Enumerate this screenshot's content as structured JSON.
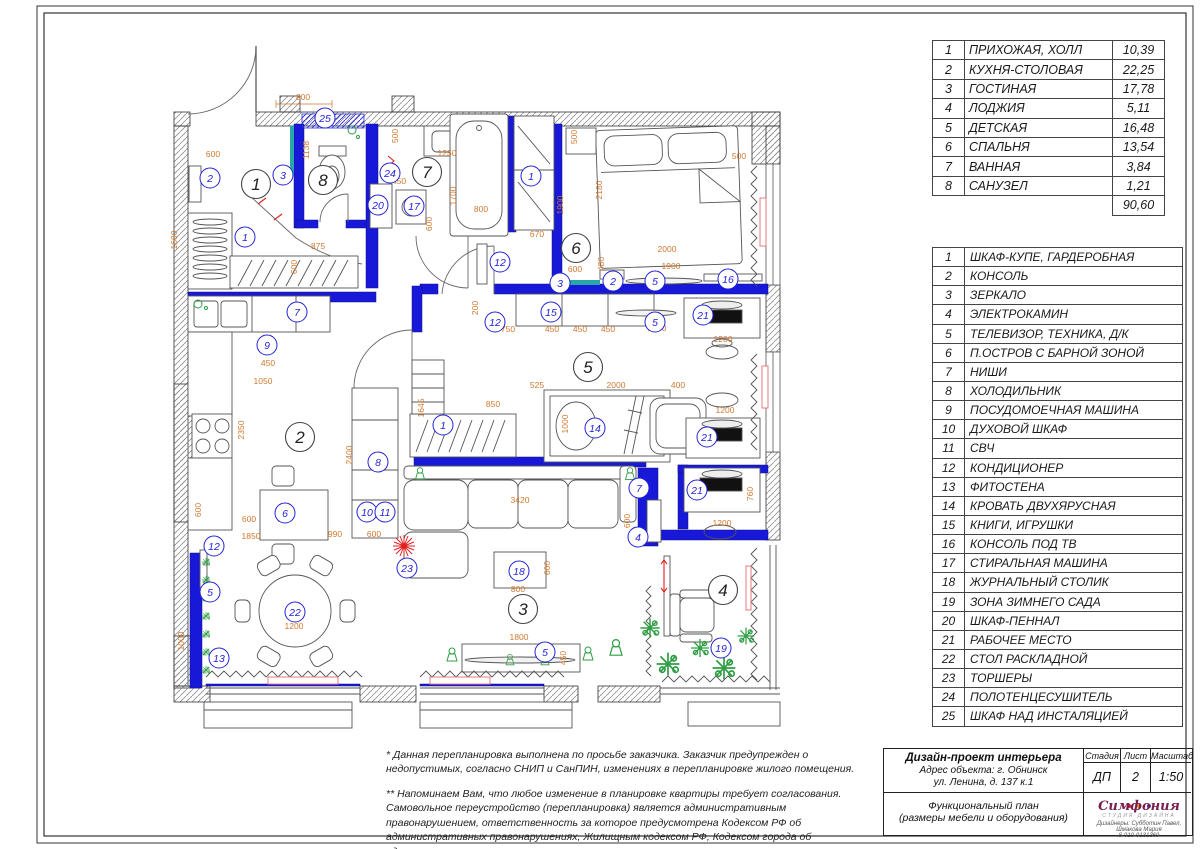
{
  "rooms_table": {
    "rows": [
      {
        "n": "1",
        "name": "ПРИХОЖАЯ, ХОЛЛ",
        "area": "10,39"
      },
      {
        "n": "2",
        "name": "КУХНЯ-СТОЛОВАЯ",
        "area": "22,25"
      },
      {
        "n": "3",
        "name": "ГОСТИНАЯ",
        "area": "17,78"
      },
      {
        "n": "4",
        "name": "ЛОДЖИЯ",
        "area": "5,11"
      },
      {
        "n": "5",
        "name": "ДЕТСКАЯ",
        "area": "16,48"
      },
      {
        "n": "6",
        "name": "СПАЛЬНЯ",
        "area": "13,54"
      },
      {
        "n": "7",
        "name": "ВАННАЯ",
        "area": "3,84"
      },
      {
        "n": "8",
        "name": "САНУЗЕЛ",
        "area": "1,21"
      }
    ],
    "total": "90,60"
  },
  "legend_table": {
    "rows": [
      {
        "n": "1",
        "name": "ШКАФ-КУПЕ, ГАРДЕРОБНАЯ"
      },
      {
        "n": "2",
        "name": "КОНСОЛЬ"
      },
      {
        "n": "3",
        "name": "ЗЕРКАЛО"
      },
      {
        "n": "4",
        "name": "ЭЛЕКТРОКАМИН"
      },
      {
        "n": "5",
        "name": "ТЕЛЕВИЗОР, ТЕХНИКА, Д/К"
      },
      {
        "n": "6",
        "name": "П.ОСТРОВ С БАРНОЙ ЗОНОЙ"
      },
      {
        "n": "7",
        "name": "НИШИ"
      },
      {
        "n": "8",
        "name": "ХОЛОДИЛЬНИК"
      },
      {
        "n": "9",
        "name": "ПОСУДОМОЕЧНАЯ МАШИНА"
      },
      {
        "n": "10",
        "name": "ДУХОВОЙ ШКАФ"
      },
      {
        "n": "11",
        "name": "СВЧ"
      },
      {
        "n": "12",
        "name": "КОНДИЦИОНЕР"
      },
      {
        "n": "13",
        "name": "ФИТОСТЕНА"
      },
      {
        "n": "14",
        "name": "КРОВАТЬ ДВУХЯРУСНАЯ"
      },
      {
        "n": "15",
        "name": "КНИГИ, ИГРУШКИ"
      },
      {
        "n": "16",
        "name": "КОНСОЛЬ ПОД ТВ"
      },
      {
        "n": "17",
        "name": "СТИРАЛЬНАЯ МАШИНА"
      },
      {
        "n": "18",
        "name": "ЖУРНАЛЬНЫЙ СТОЛИК"
      },
      {
        "n": "19",
        "name": "ЗОНА ЗИМНЕГО САДА"
      },
      {
        "n": "20",
        "name": "ШКАФ-ПЕННАЛ"
      },
      {
        "n": "21",
        "name": "РАБОЧЕЕ МЕСТО"
      },
      {
        "n": "22",
        "name": "СТОЛ РАСКЛАДНОЙ"
      },
      {
        "n": "23",
        "name": "ТОРШЕРЫ"
      },
      {
        "n": "24",
        "name": "ПОЛОТЕНЦЕСУШИТЕЛЬ"
      },
      {
        "n": "25",
        "name": "ШКАФ НАД ИНСТАЛЯЦИЕЙ"
      }
    ]
  },
  "notes": {
    "p1": "* Данная перепланировка выполнена по просьбе заказчика. Заказчик предупрежден о недопустимых, согласно СНИП и СанПИН, изменениях в перепланировке жилого помещения.",
    "p2": "** Напоминаем Вам, что любое изменение в планировке квартиры требует согласования. Самовольное переустройство (перепланировка) является административным правонарушением, ответственность за которое предусмотрена Кодексом РФ об административных правонарушениях, Жилищным кодексом РФ, Кодексом города об административных правонарушениях."
  },
  "title_block": {
    "project": "Дизайн-проект интерьера",
    "address1": "Адрес объекта: г. Обнинск",
    "address2": "ул. Ленина, д. 137 к.1",
    "stage_label": "Стадия",
    "sheet_label": "Лист",
    "scale_label": "Масштаб",
    "stage": "ДП",
    "sheet": "2",
    "scale": "1:50",
    "doc1": "Функциональный план",
    "doc2": "(размеры мебели и оборудования)",
    "studio": "Симфония",
    "studio_sub": "СТУДИЯ ДИЗАЙНА",
    "designers": "Дизайнеры: Субботин Павел, Шмакова Мария",
    "phone": "8-910-9131369",
    "logo_dot_colors": [
      "#cc2222",
      "#e8a000",
      "#2244cc"
    ]
  },
  "plan": {
    "accent_colors": {
      "walls_blue": "#1818d8",
      "dims_orange": "#d07830",
      "items_blue": "#2323d6",
      "mirror_teal": "#27a7a7",
      "plants_green": "#2f9e44",
      "radiator_pink": "#e87a7a",
      "lamp_red": "#e02020"
    },
    "room_labels": [
      [
        "1",
        256,
        184
      ],
      [
        "8",
        323,
        180
      ],
      [
        "7",
        427,
        172
      ],
      [
        "6",
        576,
        248
      ],
      [
        "2",
        300,
        437
      ],
      [
        "5",
        588,
        367
      ],
      [
        "3",
        523,
        609
      ],
      [
        "4",
        723,
        590
      ]
    ],
    "item_labels": [
      [
        "25",
        325,
        118
      ],
      [
        "3",
        283,
        175
      ],
      [
        "2",
        210,
        178
      ],
      [
        "1",
        245,
        237
      ],
      [
        "24",
        390,
        173
      ],
      [
        "20",
        378,
        205
      ],
      [
        "17",
        414,
        206
      ],
      [
        "1",
        531,
        176
      ],
      [
        "12",
        500,
        262
      ],
      [
        "3",
        560,
        283
      ],
      [
        "2",
        613,
        281
      ],
      [
        "5",
        655,
        281
      ],
      [
        "16",
        728,
        279
      ],
      [
        "7",
        297,
        312
      ],
      [
        "15",
        551,
        312
      ],
      [
        "5",
        655,
        322
      ],
      [
        "12",
        495,
        322
      ],
      [
        "21",
        703,
        315
      ],
      [
        "9",
        267,
        345
      ],
      [
        "8",
        378,
        462
      ],
      [
        "1",
        443,
        425
      ],
      [
        "14",
        595,
        428
      ],
      [
        "21",
        707,
        437
      ],
      [
        "10",
        367,
        512
      ],
      [
        "11",
        385,
        512
      ],
      [
        "6",
        285,
        513
      ],
      [
        "12",
        214,
        546
      ],
      [
        "5",
        210,
        592
      ],
      [
        "21",
        697,
        490
      ],
      [
        "7",
        639,
        488
      ],
      [
        "4",
        638,
        537
      ],
      [
        "18",
        519,
        571
      ],
      [
        "23",
        407,
        568
      ],
      [
        "22",
        295,
        612
      ],
      [
        "13",
        219,
        658
      ],
      [
        "19",
        721,
        648
      ],
      [
        "5",
        545,
        652
      ]
    ],
    "dimensions": [
      [
        "800",
        303,
        100,
        0
      ],
      [
        "600",
        213,
        157,
        0
      ],
      [
        "1138",
        309,
        150,
        1
      ],
      [
        "500",
        398,
        136,
        1
      ],
      [
        "1250",
        447,
        156,
        0
      ],
      [
        "450",
        399,
        184,
        0
      ],
      [
        "1700",
        456,
        196,
        1
      ],
      [
        "800",
        481,
        212,
        0
      ],
      [
        "600",
        432,
        224,
        1
      ],
      [
        "500",
        577,
        137,
        1
      ],
      [
        "1900",
        563,
        205,
        1
      ],
      [
        "670",
        537,
        237,
        0
      ],
      [
        "500",
        739,
        159,
        0
      ],
      [
        "2180",
        602,
        190,
        1
      ],
      [
        "2000",
        667,
        252,
        0
      ],
      [
        "1900",
        671,
        269,
        0
      ],
      [
        "480",
        604,
        264,
        1
      ],
      [
        "600",
        575,
        272,
        0
      ],
      [
        "875",
        318,
        249,
        0
      ],
      [
        "600",
        297,
        267,
        1
      ],
      [
        "1600",
        177,
        240,
        1
      ],
      [
        "200",
        478,
        308,
        1
      ],
      [
        "750",
        508,
        332,
        0
      ],
      [
        "450",
        552,
        332,
        0
      ],
      [
        "450",
        580,
        332,
        0
      ],
      [
        "450",
        608,
        332,
        0
      ],
      [
        "385",
        559,
        311,
        1
      ],
      [
        "1200",
        657,
        331,
        0
      ],
      [
        "450",
        268,
        366,
        0
      ],
      [
        "1050",
        263,
        384,
        0
      ],
      [
        "2350",
        244,
        430,
        1
      ],
      [
        "600",
        201,
        510,
        1
      ],
      [
        "600",
        249,
        522,
        0
      ],
      [
        "600",
        284,
        522,
        0
      ],
      [
        "1850",
        251,
        539,
        0
      ],
      [
        "990",
        335,
        537,
        0
      ],
      [
        "600",
        374,
        537,
        0
      ],
      [
        "2400",
        352,
        455,
        1
      ],
      [
        "1645",
        424,
        408,
        1
      ],
      [
        "850",
        493,
        407,
        0
      ],
      [
        "525",
        537,
        388,
        0
      ],
      [
        "2000",
        616,
        388,
        0
      ],
      [
        "1000",
        568,
        424,
        1
      ],
      [
        "3420",
        520,
        503,
        0
      ],
      [
        "400",
        678,
        388,
        0
      ],
      [
        "1200",
        723,
        342,
        0
      ],
      [
        "1200",
        725,
        413,
        0
      ],
      [
        "1200",
        722,
        526,
        0
      ],
      [
        "760",
        753,
        494,
        1
      ],
      [
        "1200",
        294,
        629,
        0
      ],
      [
        "1000",
        184,
        641,
        1
      ],
      [
        "800",
        518,
        592,
        0
      ],
      [
        "600",
        550,
        568,
        1
      ],
      [
        "1800",
        519,
        640,
        0
      ],
      [
        "450",
        566,
        658,
        1
      ],
      [
        "600",
        630,
        521,
        1
      ]
    ]
  }
}
